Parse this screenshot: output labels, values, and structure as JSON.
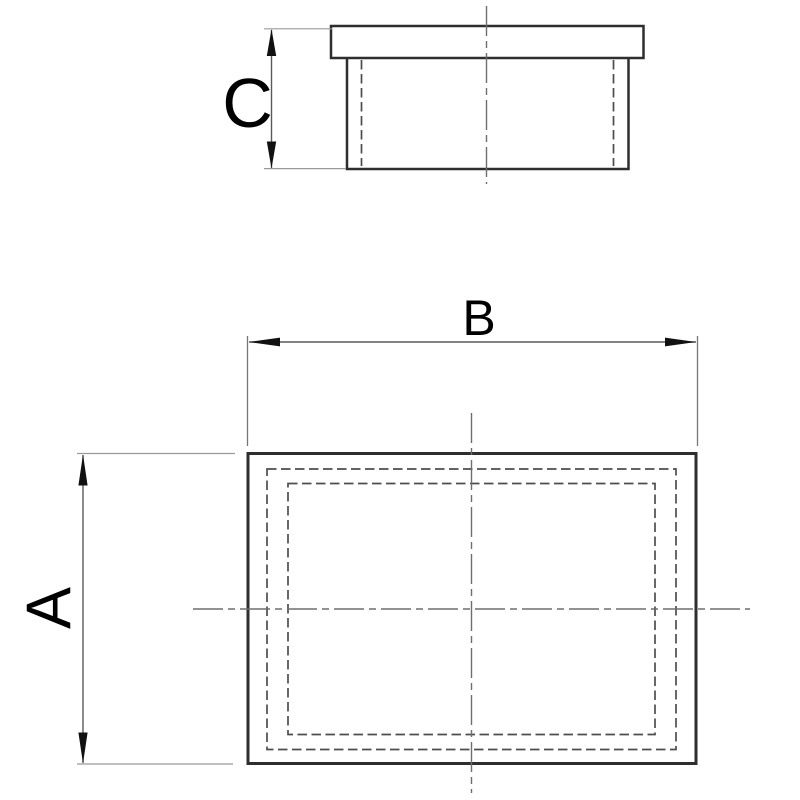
{
  "drawing": {
    "type": "technical-drawing-end-cap",
    "labels": {
      "a": "A",
      "b": "B",
      "c": "C"
    },
    "views": {
      "front_view": {
        "description": "side elevation of cap with top flange",
        "dimension": "C"
      },
      "plan_view": {
        "description": "plan view with two hidden-line inner rectangles",
        "width_dimension": "B",
        "height_dimension": "A"
      }
    },
    "colors": {
      "background": "#ffffff",
      "outline": "#2e2e2e",
      "hidden_line": "#4d4d4d",
      "centerline": "#6e6e6e",
      "dimension_line": "#5a5a5a",
      "extension_line": "#9a9a9a",
      "arrow": "#111111",
      "text": "#000000"
    }
  }
}
